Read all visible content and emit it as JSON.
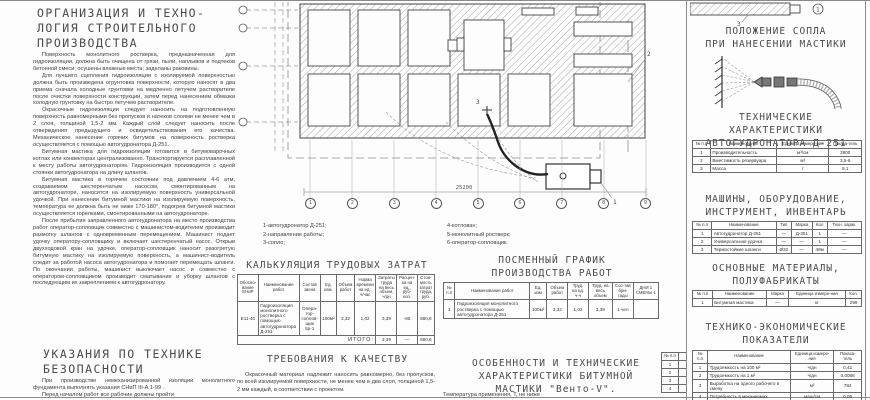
{
  "org_section": {
    "title": "ОРГАНИЗАЦИЯ И ТЕХНО-\nЛОГИЯ СТРОИТЕЛЬНОГО\nПРОИЗВОДСТВА",
    "paragraphs": [
      "Поверхность монолитного ростверка, предназначенная для гидроизоляции, должна быть очищена от грязи, пыли, наплывов и подтеков бетонной смеси; осушены влажные места; заделаны раковины.",
      "Для лучшего сцепления гидроизоляции с изолируемой поверхностью должна быть произведена огрунтовка поверхности, которую наносят в два приема сначала холодные грунтовки на медленно летучем растворителе после очистки поверхности конструкции, затем перед нанесением обмазки холодную грунтовку на быстро летучем растворителе.",
      "Окрасочные гидроизоляции следует наносить на подготовленную поверхность равномерными без пропусков и натеков слоями не менее чем в 2 слоя, толщиной 1,5-2 мм. Каждый слой следует наносить после отверждения предыдущего и освидетельствования его качества. Механическое нанесение горячих битумов на поверхность ростверка осуществляется с помощью автогудронатора Д-251.",
      "Битумная мастика для гидроизоляции готовится в битумоварочных котлах или конвекторах централизованно. Транспортируется расплавленной к месту работы автогудронатором. Гидроизоляция производится с одной стоянки автогудронатора на длину шлангов.",
      "Битумная мастика в горячем состоянии под давлением 4-6 атм, создаваемом шестеренчатым насосом, смонтированным на автогудронаторе, наносится на изолируемую поверхность универсальной удочкой. При нанесении битумной мастики на изолируемую поверхность, температура ее должна быть не ниже 170-180°, подогрев битумной мастики осуществляется горелками, смонтированными на автогудронаторе.",
      "После прибытия заправленного автогудронатора на место производства работ оператор-сопловщик совместно с машинистом-водителем производит размотку шлангов с одновременным перемещением. Машинист подает удочку оператору-сопловщику и включает шестеренчатый насос. Открыв двухходовой кран на удочке, оператор-сопловщик наносит разогретую битумную мастику на изолируемую поверхность, а машинист-водитель следит за работой насоса автогудронатора и помогает перемещать шланги. По окончании работы, машинист выключает насос и совместно с оператором-сопловщиком производит сматывание и уборку шлангов с последующим их закреплением к автогудронатору."
    ]
  },
  "safety_section": {
    "title": "УКАЗАНИЯ ПО ТЕХНИКЕ\nБЕЗОПАСНОСТИ",
    "paragraphs": [
      "При производстве немеханизированной изоляции монолитного фундамента выполнять указания СНиП III-А 1-99 .",
      "Перед началом работ все рабочие должны пройти"
    ]
  },
  "plan": {
    "axis_numbers": [
      "1",
      "2",
      "3",
      "4",
      "5",
      "6",
      "7",
      "8",
      "9"
    ],
    "dimension": "25200",
    "callouts": {
      "c1": "1",
      "c2": "2",
      "c3": "3"
    },
    "legend_col1": [
      "1-автогудронатор Д-251;",
      "2-направление работы;",
      "3-сопло;"
    ],
    "legend_col2": [
      "4-котлован;",
      "5-монолитный ростверк;",
      "6-оператор-сопловщик."
    ]
  },
  "kalk": {
    "title": "КАЛЬКУЛЯЦИЯ ТРУДОВЫХ ЗАТРАТ",
    "headers": [
      "Обосно-вание ЕНиР",
      "Наименование работ",
      "Состав звена",
      "Ед. изм.",
      "Объем работ",
      "Норма времени на ед., ч/час",
      "Затраты труда на весь объем, ч/дн",
      "Расцен-ка на ед., руб-коп.",
      "Стои-мость затрат труда, руб."
    ],
    "rows": [
      [
        "Е11-40",
        "Гидроизоляция монолитного ростверка с помощью автогудронатора Д-251",
        "Опера-тор-соплов-щик 5р-1",
        "100м²",
        "3,32",
        "1,02",
        "3,39",
        "-85",
        "680,6"
      ]
    ],
    "total_label": "ИТОГО:",
    "total": {
      "labor": "3,39",
      "rate": "—",
      "cost": "680,6"
    }
  },
  "grafik": {
    "title": "ПОСМЕННЫЙ ГРАФИК\nПРОИЗВОДСТВА РАБОТ",
    "headers": [
      "№ п.п",
      "Наименование работ",
      "Ед. изм",
      "Объем работ",
      "Труд. на ед. ч-ч",
      "Труд. на весь объем",
      "Сос-тав бри-гады",
      "ДНИ 1 СМЕНЫ 1"
    ],
    "rows": [
      [
        "1",
        "Гидроизоляция монолитного ростверка с помощью автогудронатора Д-251",
        "100м²",
        "3,32",
        "1,02",
        "3,39",
        "1 чел",
        ""
      ]
    ]
  },
  "quality_section": {
    "title": "ТРЕБОВАНИЯ К КАЧЕСТВУ",
    "paragraph": "Окрасочный материал надлежит наносить равномерно, без пропусков, по всей изолируемой поверхности, не менее чем в два слоя, толщиной 1,5-2 мм каждый, в соответствии с проектом."
  },
  "mastic_section": {
    "title": "ОСОБЕННОСТИ И ТЕХНИЧЕСКИЕ\nХАРАКТЕРИСТИКИ БИТУМНОЙ\nМАСТИКИ \"Венто-V\".",
    "paragraph": "Температура применения, Т, не ниже",
    "list_header": "№ п.п",
    "list_rows": [
      [
        "1",
        ""
      ],
      [
        "2",
        ""
      ],
      [
        "3",
        ""
      ],
      [
        "4",
        ""
      ]
    ]
  },
  "nozzle_section": {
    "title": "ПОЛОЖЕНИЕ СОПЛА\nПРИ НАНЕСЕНИИ МАСТИКИ",
    "fragment_callout": "1",
    "fragment_label": "3"
  },
  "tech_section": {
    "title": "ТЕХНИЧЕСКИЕ ХАРАКТЕРИСТИКИ\nАВТОГУДРОНАТОРА Д-251",
    "headers": [
      "№ п.п",
      "Наименование",
      "Единица измере-ния",
      "Показа-тель"
    ],
    "rows": [
      [
        "1",
        "Производительность",
        "м³/см",
        "2800"
      ],
      [
        "2",
        "Вместимость резервуара",
        "м³",
        "3,5-6"
      ],
      [
        "3",
        "Масса",
        "т",
        "9,1"
      ]
    ]
  },
  "machines_section": {
    "title": "МАШИНЫ, ОБОРУДОВАНИЕ,\nИНСТРУМЕНТ, ИНВЕНТАРЬ",
    "headers": [
      "№ п.п",
      "Наименование",
      "Тип",
      "Марка",
      "Кол",
      "Техн. харак."
    ],
    "rows": [
      [
        "1",
        "Автогудронатор Д-251",
        "—",
        "Д-251",
        "1",
        "—"
      ],
      [
        "2",
        "Универсальная удочка",
        "—",
        "—",
        "1",
        "—"
      ],
      [
        "3",
        "Термостойкие шланги",
        "Ø32",
        "—",
        "48м",
        "—"
      ]
    ]
  },
  "materials_section": {
    "title": "ОСНОВНЫЕ МАТЕРИАЛЫ,\nПОЛУФАБРИКАТЫ",
    "headers": [
      "№ п.п",
      "Наименование",
      "Марка",
      "Единица измере-ния",
      "Кол."
    ],
    "rows": [
      [
        "1",
        "Битумная мастика",
        "—",
        "кг",
        "299"
      ]
    ]
  },
  "tep_section": {
    "title": "ТЕХНИКО-ЭКОНОМИЧЕСКИЕ\nПОКАЗАТЕЛИ",
    "headers": [
      "№ п.п",
      "Наименование",
      "Единица измере-ния",
      "Показа-тель"
    ],
    "rows": [
      [
        "1",
        "Трудоемкость на 100 м²",
        "ч/дн",
        "0,42"
      ],
      [
        "2",
        "Трудоемкость на 1 м²",
        "ч/дн",
        "0,0088"
      ],
      [
        "3",
        "Выработка на одного рабочего в смену",
        "м²",
        "784"
      ],
      [
        "4",
        "Потребность в механизмах",
        "маш/см",
        "0,06"
      ]
    ]
  }
}
